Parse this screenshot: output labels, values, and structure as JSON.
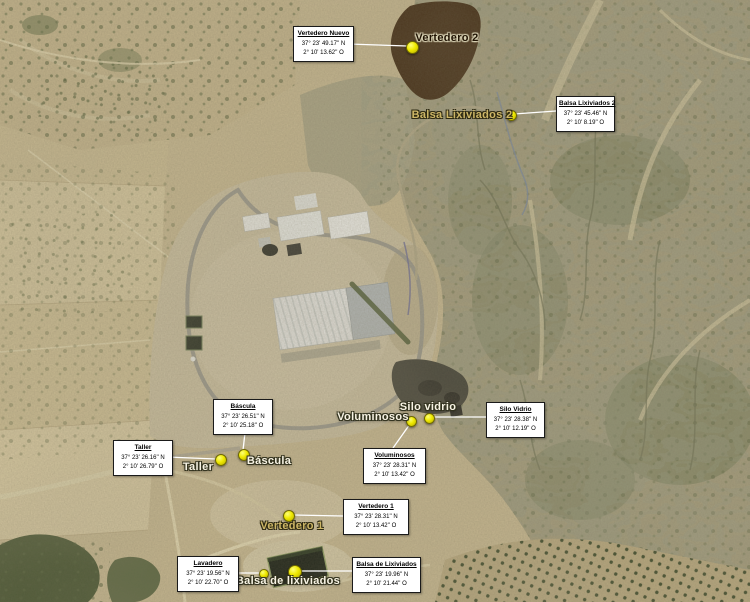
{
  "figure": {
    "description": "Vista aérea anotada de un complejo de tratamiento de residuos con localizaciones señaladas",
    "language": "es"
  },
  "colors": {
    "marker_fill": "#efe900",
    "marker_border": "#6e6800",
    "leader_line": "#ffffff",
    "callout_bg": "#ffffff",
    "callout_border": "#1a1a1a",
    "vertedero2_overlay": "#371f07"
  },
  "callouts": [
    {
      "id": "vertedero-nuevo",
      "title": "Vertedero Nuevo",
      "lat": "37° 23' 49.17'' N",
      "lon": "2° 10' 13.62'' O",
      "x": 293,
      "y": 26,
      "w": 55,
      "line": {
        "x1": 348,
        "y1": 44,
        "x2": 407,
        "y2": 46
      }
    },
    {
      "id": "balsa-lixiviados-2",
      "title": "Balsa Lixiviados 2",
      "lat": "37° 23' 45.46'' N",
      "lon": "2° 10'  8.19'' O",
      "x": 556,
      "y": 96,
      "w": 53,
      "line": {
        "x1": 556,
        "y1": 111,
        "x2": 514,
        "y2": 114
      }
    },
    {
      "id": "bascula",
      "title": "Báscula",
      "lat": "37° 23' 26.51'' N",
      "lon": "2° 10' 25.18'' O",
      "x": 213,
      "y": 399,
      "w": 54,
      "line": {
        "x1": 245,
        "y1": 433,
        "x2": 243,
        "y2": 450
      }
    },
    {
      "id": "taller",
      "title": "Taller",
      "lat": "37° 23' 26.16'' N",
      "lon": "2° 10' 26.79'' O",
      "x": 113,
      "y": 440,
      "w": 54,
      "line": {
        "x1": 167,
        "y1": 457,
        "x2": 216,
        "y2": 459
      }
    },
    {
      "id": "silo-vidrio",
      "title": "Silo Vidrio",
      "lat": "37° 23' 28.38'' N",
      "lon": "2° 10' 12.19'' O",
      "x": 486,
      "y": 402,
      "w": 53,
      "line": {
        "x1": 486,
        "y1": 417,
        "x2": 432,
        "y2": 417
      }
    },
    {
      "id": "voluminosos",
      "title": "Voluminosos",
      "lat": "37° 23' 28.31'' N",
      "lon": "2° 10' 13.42'' O",
      "x": 363,
      "y": 448,
      "w": 57,
      "line": {
        "x1": 410,
        "y1": 424,
        "x2": 393,
        "y2": 448
      }
    },
    {
      "id": "vertedero-1",
      "title": "Vertedero 1",
      "lat": "37° 23' 28.31'' N",
      "lon": "2° 10' 13.42'' O",
      "x": 343,
      "y": 499,
      "w": 60,
      "line": {
        "x1": 343,
        "y1": 516,
        "x2": 293,
        "y2": 515
      }
    },
    {
      "id": "lavadero",
      "title": "Lavadero",
      "lat": "37° 23' 19.56'' N",
      "lon": "2° 10' 22.70'' O",
      "x": 177,
      "y": 556,
      "w": 56,
      "line": {
        "x1": 236,
        "y1": 573,
        "x2": 260,
        "y2": 573
      }
    },
    {
      "id": "balsa-de-lixiviados",
      "title": "Balsa de Lixiviados",
      "lat": "37° 23' 19.96'' N",
      "lon": "2° 10' 21.44'' O",
      "x": 352,
      "y": 557,
      "w": 63,
      "line": {
        "x1": 352,
        "y1": 571,
        "x2": 299,
        "y2": 571
      }
    }
  ],
  "labels": [
    {
      "id": "vertedero-2",
      "text": "Vertedero 2",
      "x": 447,
      "y": 38,
      "tone": "dark"
    },
    {
      "id": "balsa-lixiviados-2",
      "text": "Balsa Lixiviados 2",
      "x": 462,
      "y": 115,
      "tone": "khaki"
    },
    {
      "id": "taller",
      "text": "Taller",
      "x": 198,
      "y": 467,
      "tone": "light"
    },
    {
      "id": "bascula",
      "text": "Báscula",
      "x": 269,
      "y": 461,
      "tone": "light"
    },
    {
      "id": "voluminosos",
      "text": "Voluminosos",
      "x": 373,
      "y": 417,
      "tone": "light"
    },
    {
      "id": "silo-vidrio",
      "text": "Silo vidrio",
      "x": 428,
      "y": 407,
      "tone": "light"
    },
    {
      "id": "vertedero-1",
      "text": "Vertedero 1",
      "x": 292,
      "y": 526,
      "tone": "khaki"
    },
    {
      "id": "balsa-de-lixiviados",
      "text": "Balsa de lixiviados",
      "x": 288,
      "y": 581,
      "tone": "light"
    }
  ],
  "markers": [
    {
      "id": "vertedero-2",
      "x": 411,
      "y": 46,
      "r": 5.5
    },
    {
      "id": "balsa-lixiviados-2",
      "x": 510,
      "y": 114,
      "r": 4.5
    },
    {
      "id": "taller",
      "x": 220,
      "y": 459,
      "r": 5
    },
    {
      "id": "bascula",
      "x": 243,
      "y": 454,
      "r": 5
    },
    {
      "id": "voluminosos",
      "x": 410,
      "y": 420,
      "r": 4.5
    },
    {
      "id": "silo-vidrio",
      "x": 428,
      "y": 417,
      "r": 4.5
    },
    {
      "id": "vertedero-1",
      "x": 288,
      "y": 515,
      "r": 5
    },
    {
      "id": "lavadero",
      "x": 263,
      "y": 573,
      "r": 4
    },
    {
      "id": "balsa-de-lixiviados",
      "x": 294,
      "y": 571,
      "r": 6
    }
  ]
}
